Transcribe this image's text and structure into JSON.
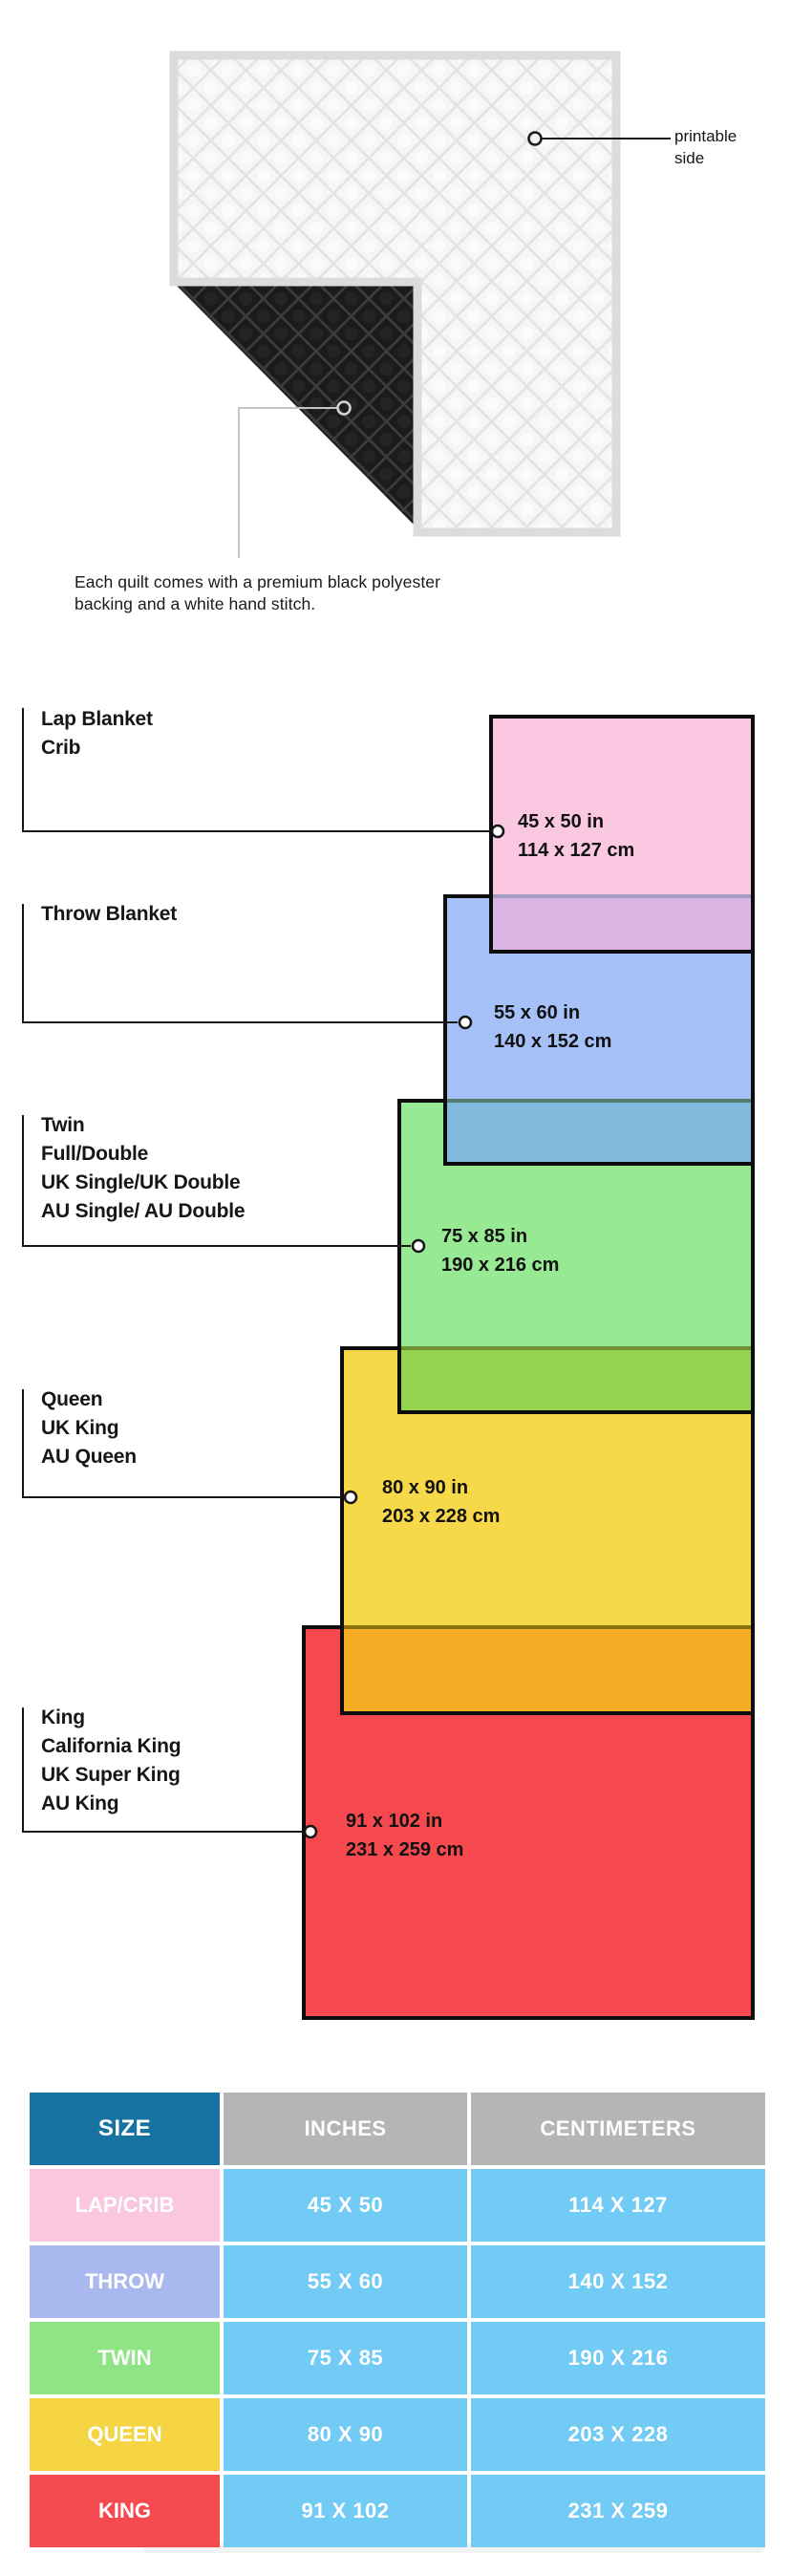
{
  "quilt": {
    "printable_label": {
      "line1": "printable",
      "line2": "side"
    },
    "caption": {
      "line1": "Each quilt comes with a premium black polyester",
      "line2": "backing and a white hand stitch."
    },
    "front_color": "#f6f6f6",
    "backing_color": "#1b1b1b"
  },
  "diagram": {
    "sizes": [
      {
        "name": "lap-crib",
        "labels": [
          "Lap Blanket",
          "Crib"
        ],
        "inches": "45 x 50 in",
        "centimeters": "114 x 127 cm",
        "fill": "#fbc8e1"
      },
      {
        "name": "throw",
        "labels": [
          "Throw Blanket"
        ],
        "inches": "55 x 60 in",
        "centimeters": "140 x 152 cm",
        "fill": "#a5c1f7"
      },
      {
        "name": "twin",
        "labels": [
          "Twin",
          "Full/Double",
          "UK Single/UK Double",
          "AU Single/ AU Double"
        ],
        "inches": "75 x 85 in",
        "centimeters": "190 x 216 cm",
        "fill": "#97ea93"
      },
      {
        "name": "queen",
        "labels": [
          "Queen",
          "UK King",
          "AU Queen"
        ],
        "inches": "80 x 90 in",
        "centimeters": "203 x 228 cm",
        "fill": "#f7d848"
      },
      {
        "name": "king",
        "labels": [
          "King",
          "California King",
          "UK Super King",
          "AU King"
        ],
        "inches": "91 x 102 in",
        "centimeters": "231 x 259 cm",
        "fill": "#f5494f"
      }
    ],
    "overlap_fills": {
      "lap_throw": "#dcb6e2",
      "throw_twin": "#82badd",
      "twin_queen": "#92d44e",
      "queen_king": "#f6ab24"
    }
  },
  "table": {
    "headers": [
      "SIZE",
      "INCHES",
      "CENTIMETERS"
    ],
    "rows": [
      {
        "size": "LAP/CRIB",
        "inches": "45 X 50",
        "centimeters": "114 X 127",
        "size_bg": "#fac7de"
      },
      {
        "size": "THROW",
        "inches": "55 X 60",
        "centimeters": "140 X 152",
        "size_bg": "#aab8f0"
      },
      {
        "size": "TWIN",
        "inches": "75 X 85",
        "centimeters": "190 X 216",
        "size_bg": "#8fe585"
      },
      {
        "size": "QUEEN",
        "inches": "80 X 90",
        "centimeters": "203 X 228",
        "size_bg": "#f5d544"
      },
      {
        "size": "KING",
        "inches": "91 X 102",
        "centimeters": "231 X 259",
        "size_bg": "#f54a50"
      }
    ],
    "colors": {
      "header_size_bg": "#1572a1",
      "header_other_bg": "#b5b5b5",
      "value_cell_bg": "#72cbf4",
      "text": "#ffffff"
    }
  }
}
